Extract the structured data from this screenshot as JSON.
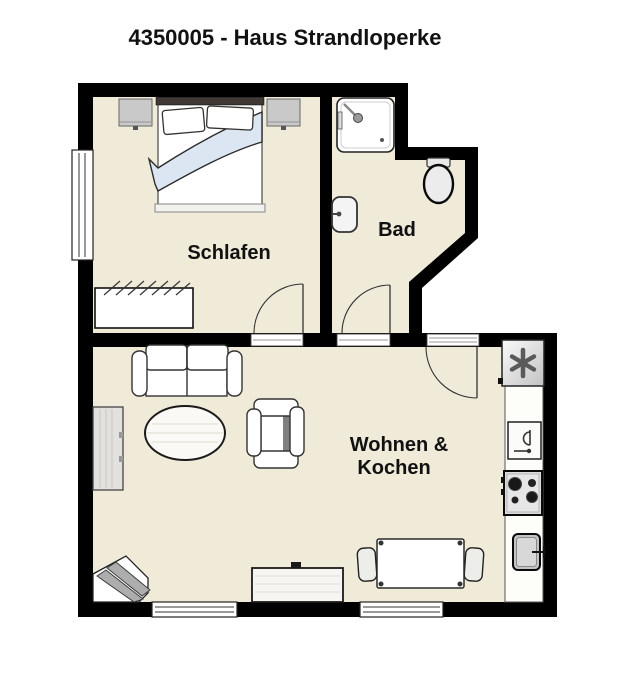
{
  "title": "4350005 - Haus Strandloperke",
  "rooms": {
    "schlafen": {
      "label": "Schlafen"
    },
    "bad": {
      "label": "Bad"
    },
    "wohnen_kochen": {
      "label_line1": "Wohnen &",
      "label_line2": "Kochen"
    }
  },
  "colors": {
    "wall": "#000000",
    "floor": "#f0ead9",
    "duvet": "#dce6f2",
    "furniture_gray": "#c9c9c9",
    "background": "#ffffff",
    "text": "#111111"
  },
  "furniture": {
    "schlafen": [
      "double-bed",
      "pillows",
      "duvet",
      "nightstand-left",
      "nightstand-right",
      "wardrobe",
      "window-left"
    ],
    "bad": [
      "shower",
      "toilet",
      "wash-basin",
      "door-arc"
    ],
    "wohnen_kochen": [
      "sofa",
      "coffee-table",
      "armchair",
      "sideboard",
      "corner-rack",
      "tv-board",
      "dining-table",
      "chair-left",
      "chair-right",
      "entrance-door",
      "window-bottom-left",
      "window-bottom-right"
    ],
    "kitchen_line": [
      "fridge-freezer",
      "kitchen-counter",
      "built-in-appliance",
      "stove-4-burners",
      "kitchen-sink"
    ]
  }
}
